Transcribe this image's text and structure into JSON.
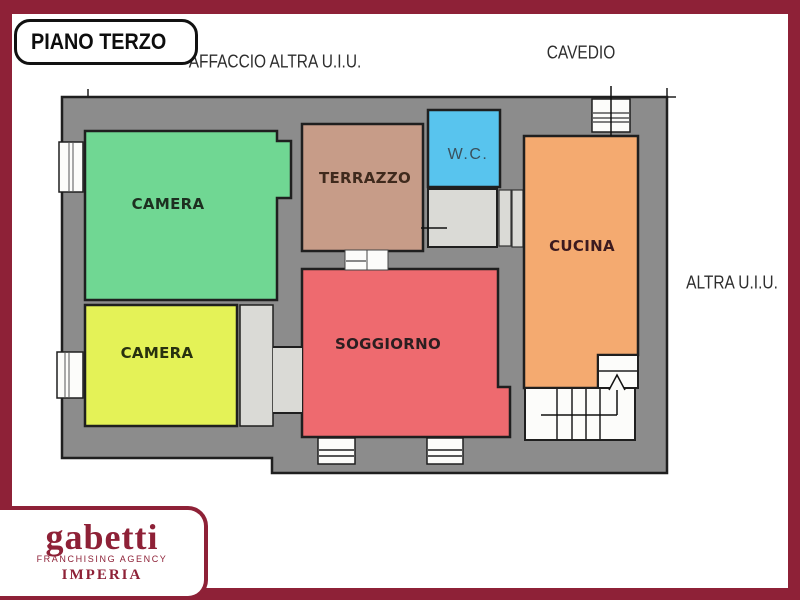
{
  "page": {
    "background": "#ffffff",
    "frame_color": "#8e2137"
  },
  "title_box": {
    "label": "PIANO TERZO"
  },
  "annotations": {
    "affaccio": "AFFACCIO ALTRA U.I.U.",
    "cavedio": "CAVEDIO",
    "altra_uiu": "ALTRA U.I.U."
  },
  "rooms": [
    {
      "id": "camera-1",
      "label": "CAMERA",
      "color": "#70d793"
    },
    {
      "id": "camera-2",
      "label": "CAMERA",
      "color": "#e4f257"
    },
    {
      "id": "terrazzo",
      "label": "TERRAZZO",
      "color": "#c79c88"
    },
    {
      "id": "wc",
      "label": "W.C.",
      "color": "#58c4ee"
    },
    {
      "id": "cucina",
      "label": "CUCINA",
      "color": "#f4aa70"
    },
    {
      "id": "soggiorno",
      "label": "SOGGIORNO",
      "color": "#ee6a6f"
    }
  ],
  "palette": {
    "wall_gray": "#8c8c8c",
    "floor_light_gray": "#dadad6",
    "outline_black": "#1f1f1f"
  },
  "logo": {
    "brand": "gabetti",
    "tagline": "FRANCHISING AGENCY",
    "city": "IMPERIA",
    "color": "#8e2137"
  }
}
